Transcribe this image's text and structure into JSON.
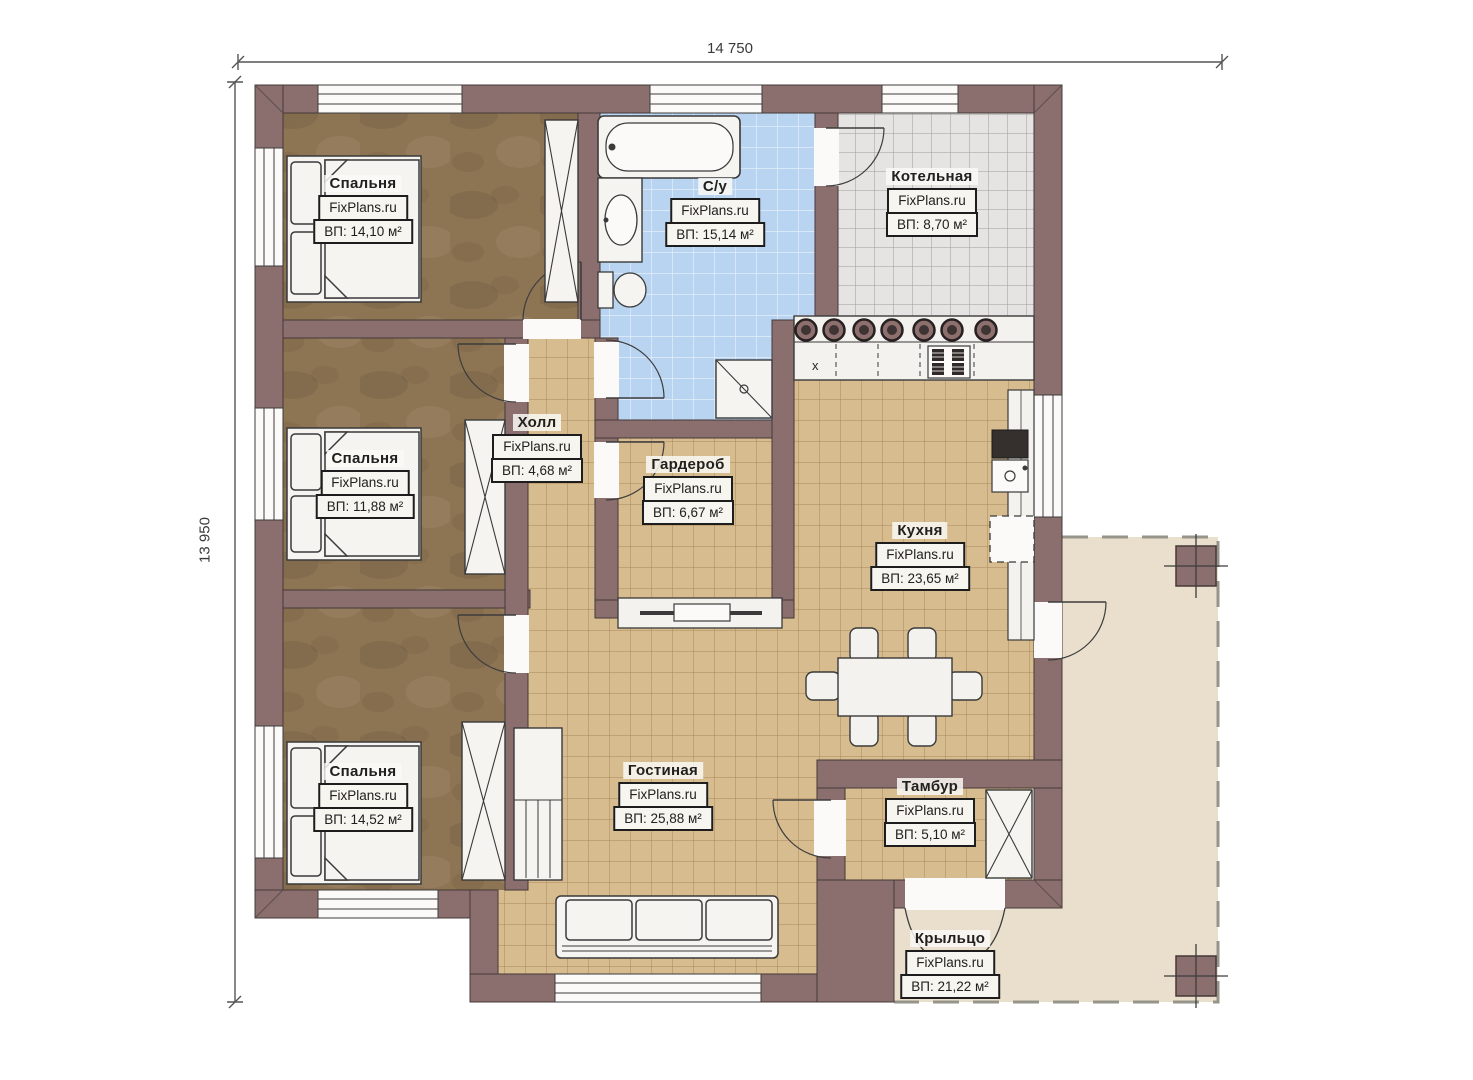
{
  "dimensions": {
    "width_label": "14 750",
    "height_label": "13 950"
  },
  "kitchen": {
    "cabinet_mark": "x"
  },
  "rooms": [
    {
      "name": "Спальня",
      "brand": "FixPlans.ru",
      "area": "ВП: 14,10 м²"
    },
    {
      "name": "С/у",
      "brand": "FixPlans.ru",
      "area": "ВП: 15,14 м²"
    },
    {
      "name": "Котельная",
      "brand": "FixPlans.ru",
      "area": "ВП: 8,70 м²"
    },
    {
      "name": "Спальня",
      "brand": "FixPlans.ru",
      "area": "ВП: 11,88 м²"
    },
    {
      "name": "Холл",
      "brand": "FixPlans.ru",
      "area": "ВП: 4,68 м²"
    },
    {
      "name": "Гардероб",
      "brand": "FixPlans.ru",
      "area": "ВП: 6,67 м²"
    },
    {
      "name": "Кухня",
      "brand": "FixPlans.ru",
      "area": "ВП: 23,65 м²"
    },
    {
      "name": "Спальня",
      "brand": "FixPlans.ru",
      "area": "ВП: 14,52 м²"
    },
    {
      "name": "Гостиная",
      "brand": "FixPlans.ru",
      "area": "ВП: 25,88 м²"
    },
    {
      "name": "Тамбур",
      "brand": "FixPlans.ru",
      "area": "ВП: 5,10 м²"
    },
    {
      "name": "Крыльцо",
      "brand": "FixPlans.ru",
      "area": "ВП: 21,22 м²"
    }
  ],
  "colors": {
    "wall": "#8a6f6e",
    "bedroom_floor": "#8d7453",
    "tile_floor": "#d6bc8e",
    "bathroom_tile": "#b8d4f0",
    "boiler_tile": "#e5e4e2",
    "porch_floor": "#e9dfcc",
    "fixture_white": "#f6f4f0"
  }
}
